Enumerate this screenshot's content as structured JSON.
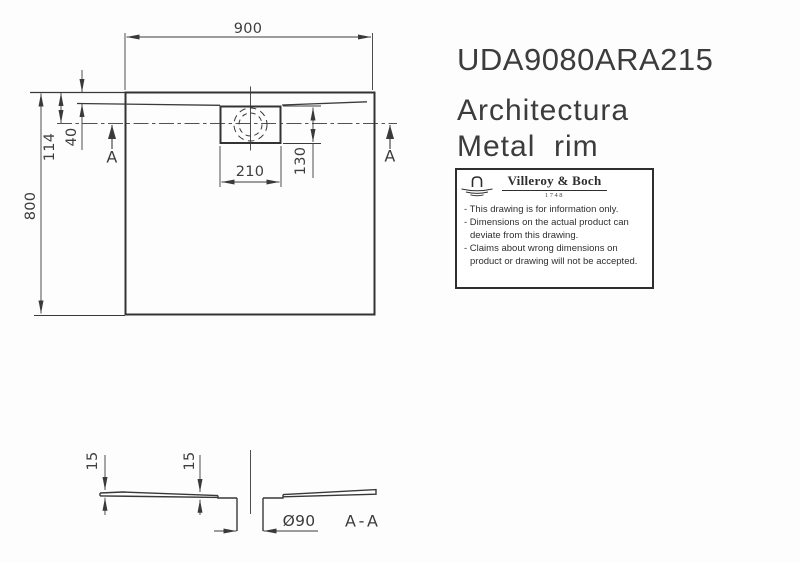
{
  "title_block": {
    "article_number": "UDA9080ARA215",
    "series": "Architectura",
    "variant": "Metal  rim"
  },
  "plan": {
    "width": "900",
    "height": "800",
    "edge_to_drain_center": "114",
    "rim_width": "40",
    "drain_box_width": "210",
    "drain_box_height": "130",
    "section_marker": "A"
  },
  "section": {
    "thickness_edge": "15",
    "thickness_center": "15",
    "drain_diameter": "Ø90",
    "label": "A-A"
  },
  "manufacturer": {
    "brand": "Villeroy & Boch",
    "year": "1748",
    "notes": [
      "- This drawing is for information only.",
      "- Dimensions on the actual product can",
      "deviate from this drawing.",
      "- Claims about wrong dimensions on",
      "product or drawing will not be accepted."
    ]
  },
  "colors": {
    "line": "#3a3a3a",
    "thick_line": "#333333",
    "text": "#3c3c3c",
    "background": "#ffffff"
  }
}
